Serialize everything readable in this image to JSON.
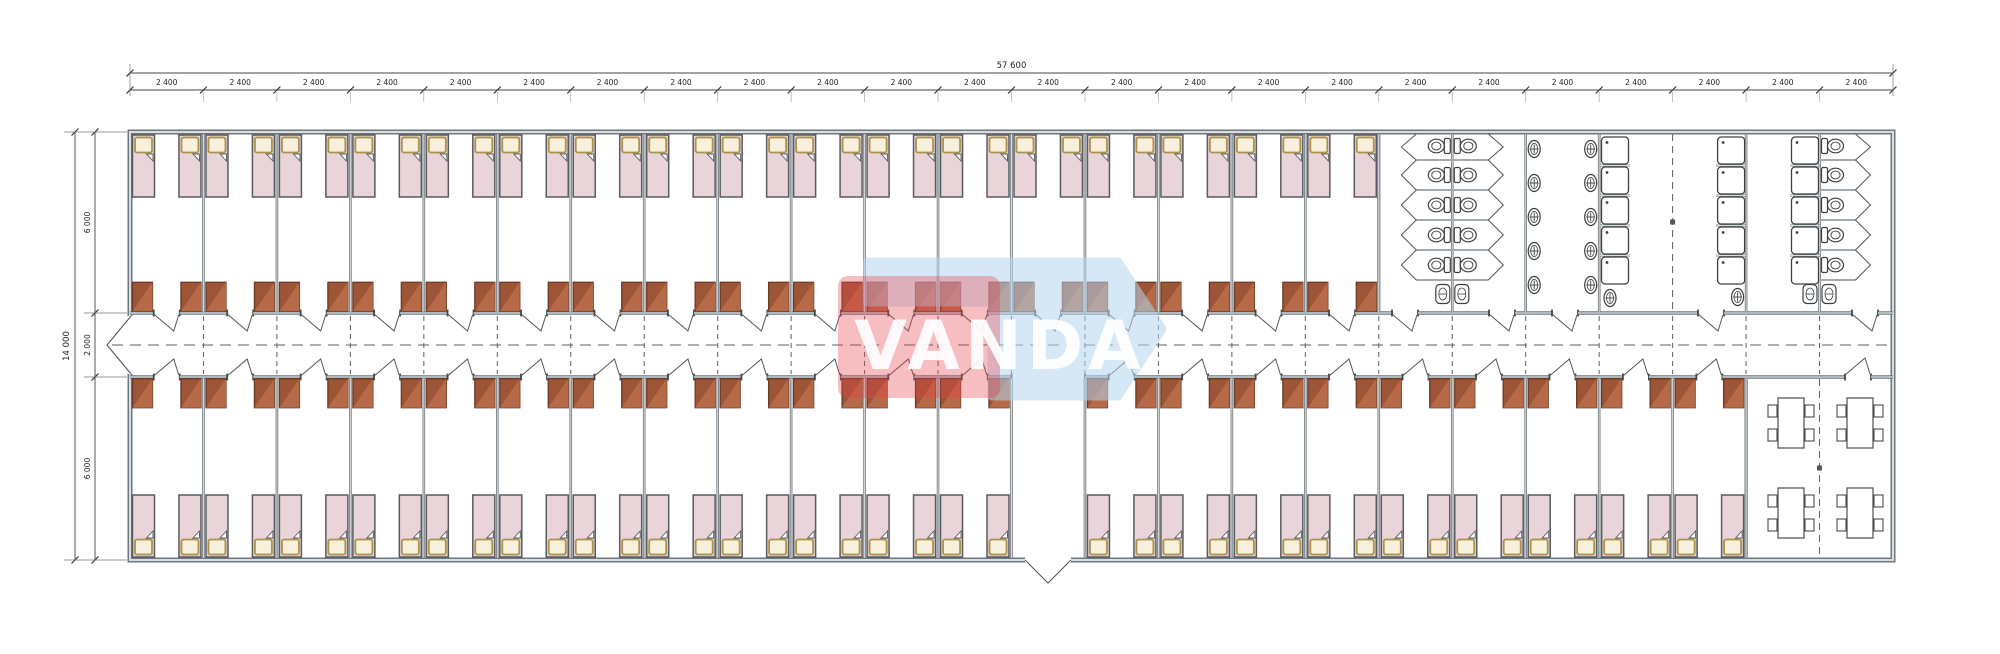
{
  "title": "Modular dormitory floor plan",
  "watermark": {
    "text": "VANDA",
    "text_color": "#ffffff",
    "red": "#e8404c",
    "blue": "#b5d6ee",
    "blue_pts": "868,262 1118,262 1162,329 1118,396 992,396 992,302 868,302",
    "red_rect": [
      838,
      276,
      162,
      122
    ]
  },
  "dims": {
    "total_width": "57 600",
    "module": "2 400",
    "module_count": 24,
    "total_height": "14 000",
    "height_segments": [
      "6 000",
      "2 000",
      "6 000"
    ]
  },
  "colors": {
    "wall_dark": "#6d777d",
    "wall_core": "#d9dee1",
    "jamb": "#41464a",
    "bed_fill": "#e9d4d9",
    "bed_stroke": "#585b5f",
    "pillow_fill": "#f6f0dd",
    "pillow_stroke": "#ab914a",
    "wardrobe_fill": "#9d5538",
    "wardrobe_light": "#bc6e4a",
    "wardrobe_stroke": "#6b3a24",
    "fixture_stroke": "#3f3f3f",
    "fixture_fill": "#ffffff",
    "swing": "#555555",
    "dash": "#5f5f5f",
    "dim_line": "#444444",
    "dim_text": "#222222",
    "marker": "#555555"
  },
  "geom": {
    "canvas": [
      2000,
      654
    ],
    "bx0": 130,
    "bx1": 1893,
    "by0": 132,
    "by1": 560,
    "corr_top": 313,
    "corr_bot": 377,
    "modules": 24,
    "door_half": 13,
    "bed": {
      "w": 22,
      "h": 62
    },
    "wardrobe": {
      "w": 20,
      "h": 29
    },
    "top_rooms": [
      [
        0,
        16
      ]
    ],
    "bottom_rooms": [
      [
        0,
        11
      ],
      [
        13,
        21
      ]
    ],
    "entrance": {
      "module": 12,
      "door": [
        1025,
        1071
      ],
      "apex": [
        1048,
        583
      ]
    },
    "west_door": {
      "y": [
        316,
        374
      ],
      "apex": [
        107,
        345
      ]
    },
    "sanitary": {
      "walls": [
        1378.8,
        1452.3,
        1525.7,
        1599.2,
        1746.1,
        1819.5
      ],
      "stall_ys": [
        134,
        160,
        190,
        220,
        250,
        280
      ],
      "toilet_cys": [
        146,
        175,
        205,
        235,
        265
      ],
      "wc_center": 1452.3,
      "wc_east": 1819.5,
      "stall_depth": 36,
      "basin_cys": [
        149,
        183,
        217,
        251,
        285
      ],
      "basin_cols": [
        [
          1525.7,
          1
        ],
        [
          1599.2,
          -1
        ]
      ],
      "shower_cols": [
        1601.5,
        1717.6,
        1791.5
      ],
      "shower_ys": [
        137,
        167,
        197,
        227,
        257
      ],
      "shower_size": 27,
      "single_basins": [
        [
          1610,
          298,
          0
        ],
        [
          1746.1,
          297,
          -1
        ]
      ],
      "double_basins": [
        [
          1452.3,
          294
        ],
        [
          1819.5,
          294
        ]
      ],
      "dashed_x": 1672.6,
      "marker": [
        1672.6,
        222
      ],
      "doors": [
        [
          1392,
          1418
        ],
        [
          1489,
          1515
        ],
        [
          1552,
          1578
        ],
        [
          1698,
          1724
        ],
        [
          1852,
          1878
        ]
      ]
    },
    "dining": {
      "x0": 1746.1,
      "door": [
        1845,
        1871
      ],
      "dashed_x": 1819.5,
      "marker_y": 468,
      "tables": [
        [
          1791,
          398
        ],
        [
          1860,
          398
        ],
        [
          1791,
          488
        ],
        [
          1860,
          488
        ]
      ]
    }
  }
}
